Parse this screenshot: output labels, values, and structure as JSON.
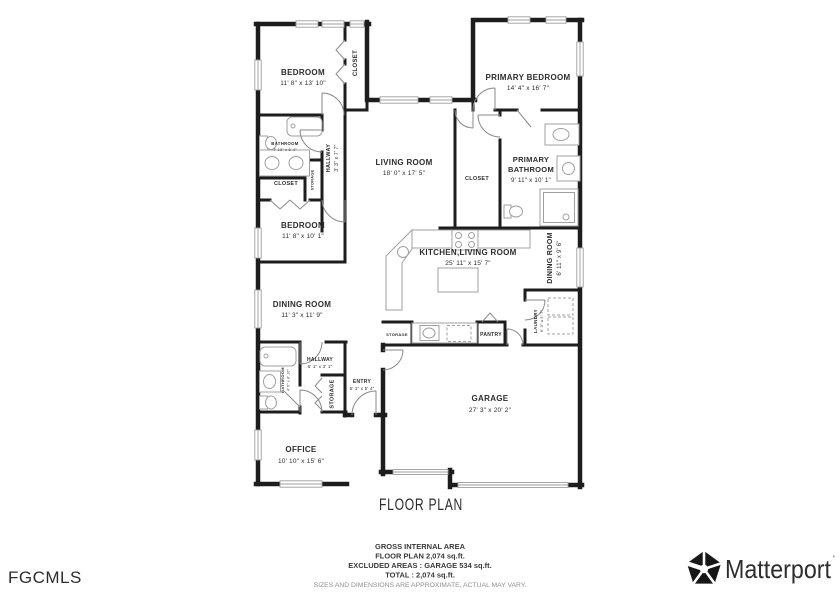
{
  "title": "FLOOR PLAN",
  "watermark": "FGCMLS",
  "brand": {
    "name": "Matterport",
    "mark": "'"
  },
  "footer": {
    "line1": "GROSS INTERNAL AREA",
    "line2": "FLOOR PLAN 2,074 sq.ft.",
    "line3": "EXCLUDED AREAS : GARAGE 534 sq.ft.",
    "line4": "TOTAL : 2,074 sq.ft.",
    "disclaimer": "SIZES AND DIMENSIONS ARE APPROXIMATE, ACTUAL MAY VARY."
  },
  "colors": {
    "wall": "#1d1d1d",
    "fixture": "#a0a0a0",
    "text": "#2d2d2d",
    "watermark": "#a3a3a3",
    "brand": "#171717"
  },
  "rooms": {
    "bedroom_tl": {
      "name": "BEDROOM",
      "dims": "11' 8\" x 13' 10\""
    },
    "closet_tl": {
      "name": "CLOSET"
    },
    "primary_bedroom": {
      "name": "PRIMARY BEDROOM",
      "dims": "14' 4\" x 16' 7\""
    },
    "bathroom_tl": {
      "name": "BATHROOM",
      "dims": "7' 10\" x 6' 4\""
    },
    "storage_bath": {
      "name": "STORAGE"
    },
    "hallway_top": {
      "name": "HALLWAY",
      "dims": "3' 3\" x 7' 7\""
    },
    "closet_left": {
      "name": "CLOSET"
    },
    "bedroom_left": {
      "name": "BEDROOM",
      "dims": "11' 8\" x 10' 1\""
    },
    "living_room": {
      "name": "LIVING ROOM",
      "dims": "18' 0\" x 17' 5\""
    },
    "closet_right": {
      "name": "CLOSET"
    },
    "primary_bathroom": {
      "name_line1": "PRIMARY",
      "name_line2": "BATHROOM",
      "dims": "9' 11\" x 10' 1\""
    },
    "kitchen_living": {
      "name": "KITCHEN,LIVING ROOM",
      "dims": "25' 11\" x 15' 7\""
    },
    "dining_right": {
      "name": "DINING ROOM",
      "dims": "6' 11\" x 9' 6\""
    },
    "dining_left": {
      "name": "DINING ROOM",
      "dims": "11' 3\" x 11' 9\""
    },
    "storage_kitchen": {
      "name": "STORAGE"
    },
    "pantry": {
      "name": "PANTRY"
    },
    "laundry": {
      "name": "LAUNDRY",
      "dims": "6' 3\" x 5' 7\""
    },
    "hallway_lower": {
      "name": "HALLWAY",
      "dims": "6' 1\" x 3' 1\""
    },
    "bathroom_lower": {
      "name": "BATHROOM",
      "dims": "4' 9\" x 8' 10\""
    },
    "storage_entry": {
      "name": "STORAGE"
    },
    "entry": {
      "name": "ENTRY",
      "dims": "5' 1\" x 5' 4\""
    },
    "garage": {
      "name": "GARAGE",
      "dims": "27' 3\" x 20' 2\""
    },
    "office": {
      "name": "OFFICE",
      "dims": "10' 10\" x 15' 6\""
    }
  }
}
